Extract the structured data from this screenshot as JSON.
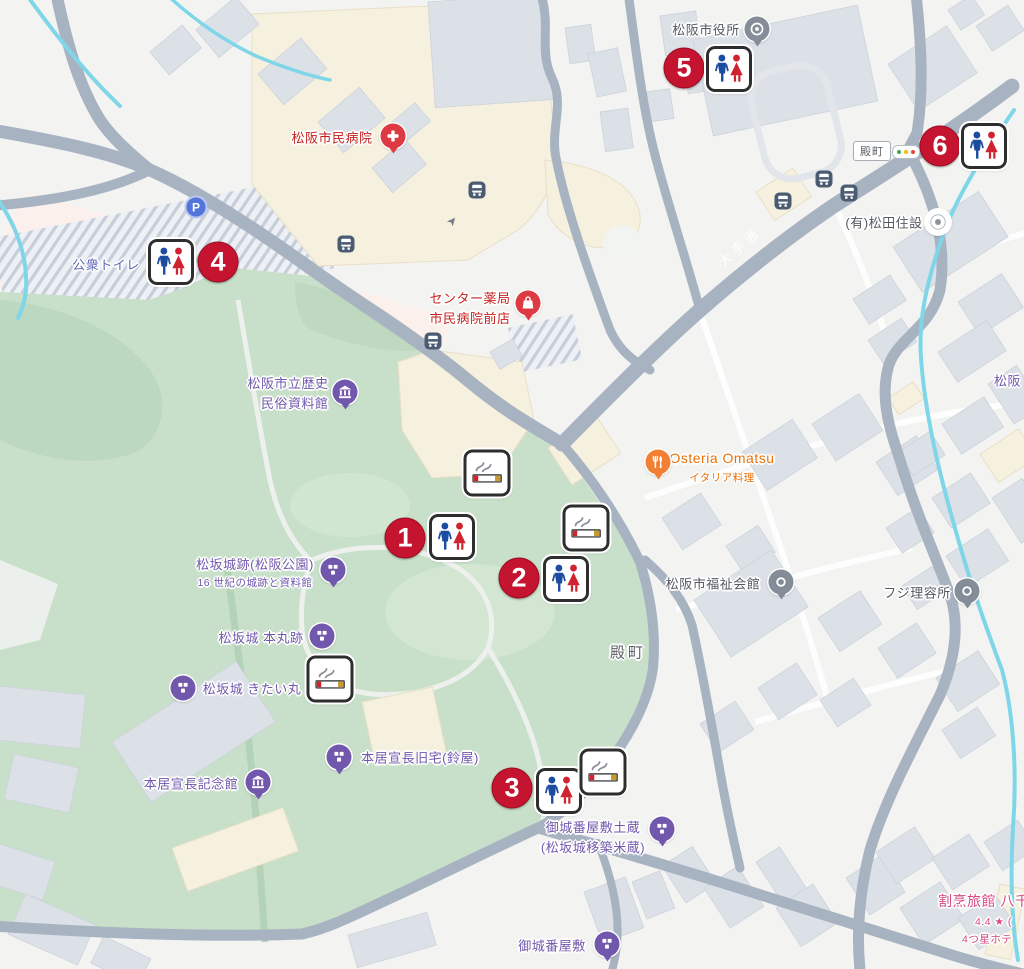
{
  "colors": {
    "marker_red": "#c41430",
    "toilet_blue": "#1b4c9f",
    "toilet_red": "#cf2330",
    "poi_purple": "#7158ad",
    "poi_orange": "#e8710a",
    "poi_red": "#c5221f",
    "poi_pink": "#d6487f",
    "poi_gray": "#555a61",
    "toilet_label_blue": "#5e68b8",
    "park_green": "#c8e0c9",
    "road_gray": "#a8b3c2",
    "water_cyan": "#7fd6e8",
    "traffic_green": "#3aa757",
    "traffic_yellow": "#fbbc04",
    "traffic_red": "#ea4335"
  },
  "markers": [
    {
      "number": "1"
    },
    {
      "number": "2"
    },
    {
      "number": "3"
    },
    {
      "number": "4"
    },
    {
      "number": "5"
    },
    {
      "number": "6"
    }
  ],
  "pois": {
    "hospital": {
      "label": "松阪市民病院"
    },
    "pharmacy": {
      "line1": "センター薬局",
      "line2": "市民病院前店"
    },
    "city_hall": {
      "label": "松阪市役所"
    },
    "matsuda": {
      "label": "(有)松田住設"
    },
    "public_toilet": {
      "label": "公衆トイレ"
    },
    "history_museum": {
      "line1": "松阪市立歴史",
      "line2": "民俗資料館"
    },
    "osteria": {
      "name": "Osteria Omatsu",
      "genre": "イタリア料理"
    },
    "castle_ruins": {
      "label": "松坂城跡(松阪公園)",
      "sub": "16 世紀の城跡と資料館"
    },
    "welfare_hall": {
      "label": "松阪市福祉会館"
    },
    "fuji_barber": {
      "label": "フジ理容所"
    },
    "honmaru": {
      "label": "松坂城 本丸跡"
    },
    "kitaimaru": {
      "label": "松坂城 きたい丸"
    },
    "norinaga_house": {
      "label": "本居宣長旧宅(鈴屋)"
    },
    "norinaga_museum": {
      "label": "本居宣長記念館"
    },
    "gojoban_dozo": {
      "line1": "御城番屋敷土蔵",
      "line2": "(松坂城移築米蔵)"
    },
    "gojoban": {
      "label": "御城番屋敷"
    },
    "ryokan": {
      "name": "割烹旅館 八千",
      "rating": "4.4 ★ (",
      "sub": "4つ星ホテ"
    },
    "matsusaka_partial": {
      "label": "松阪"
    }
  },
  "roads": {
    "otedori": {
      "label": "大手通"
    },
    "tonomachi_sign": {
      "label": "殿町"
    }
  },
  "districts": {
    "tonomachi": {
      "label": "殿町"
    }
  },
  "parking": {
    "glyph": "P"
  },
  "icons": {
    "toilet-sign-icon": "male-female-pictogram",
    "smoking-area-icon": "cigarette-with-smoke",
    "bus-stop-icon": "bus",
    "parking-icon": "letter-P-circle",
    "traffic-light-icon": "three-dots",
    "hospital-icon": "white-cross",
    "pharmacy-icon": "shopping-bag",
    "restaurant-icon": "fork-and-knife",
    "museum-icon": "classical-building",
    "historic-site-icon": "castle-blocks",
    "government-icon": "concentric-rings",
    "generic-poi-icon": "ring-dot"
  }
}
